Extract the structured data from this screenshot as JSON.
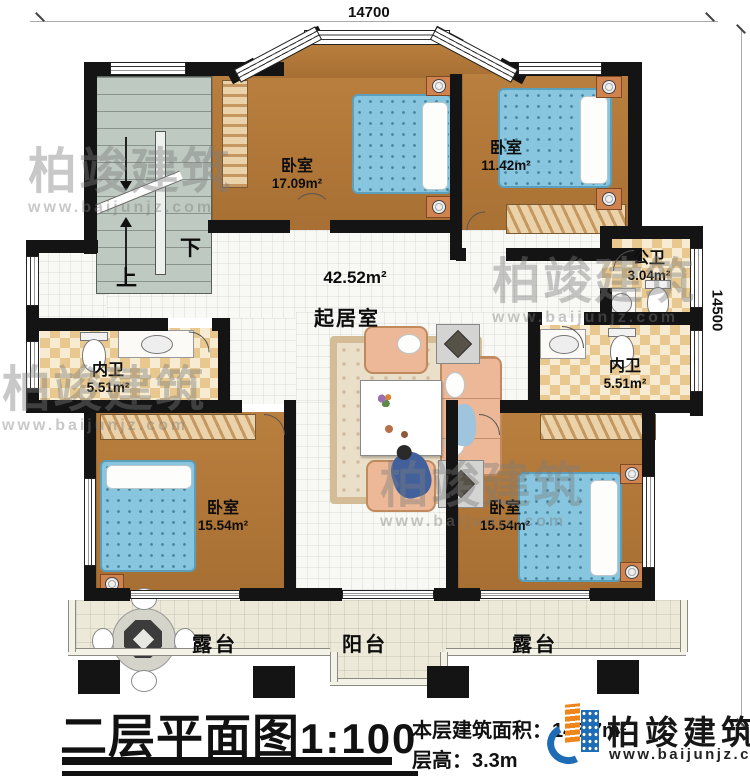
{
  "dimensions": {
    "top": "14700",
    "right": "14500"
  },
  "rooms": {
    "bedroom_tl": {
      "name": "卧室",
      "area": "17.09m²"
    },
    "bedroom_tr": {
      "name": "卧室",
      "area": "11.42m²"
    },
    "public_bath": {
      "name": "公卫",
      "area": "3.04m²"
    },
    "living": {
      "name": "起居室",
      "area": "42.52m²"
    },
    "bath_left": {
      "name": "内卫",
      "area": "5.51m²"
    },
    "bath_right": {
      "name": "内卫",
      "area": "5.51m²"
    },
    "bedroom_bl": {
      "name": "卧室",
      "area": "15.54m²"
    },
    "bedroom_br": {
      "name": "卧室",
      "area": "15.54m²"
    },
    "terrace_left": {
      "name": "露台"
    },
    "balcony": {
      "name": "阳台"
    },
    "terrace_right": {
      "name": "露台"
    }
  },
  "stairs": {
    "up_label": "上",
    "down_label": "下"
  },
  "title": {
    "main": "二层平面图",
    "scale": "1:100",
    "floor_area_label": "本层建筑面积：",
    "floor_area_value": "145.7m²",
    "floor_height_label": "层高：",
    "floor_height_value": "3.3m"
  },
  "brand": {
    "name": "柏竣建筑",
    "site": "www.baijunjz.com"
  },
  "watermark": {
    "name": "柏竣建筑",
    "site": "www.baijunjz.com"
  },
  "colors": {
    "wall": "#141414",
    "wood": "#b0783a",
    "bath_tile": "#e9c88f",
    "bed": "#87c6de",
    "brand_blue": "#1d6cb5",
    "brand_orange": "#f08519"
  }
}
